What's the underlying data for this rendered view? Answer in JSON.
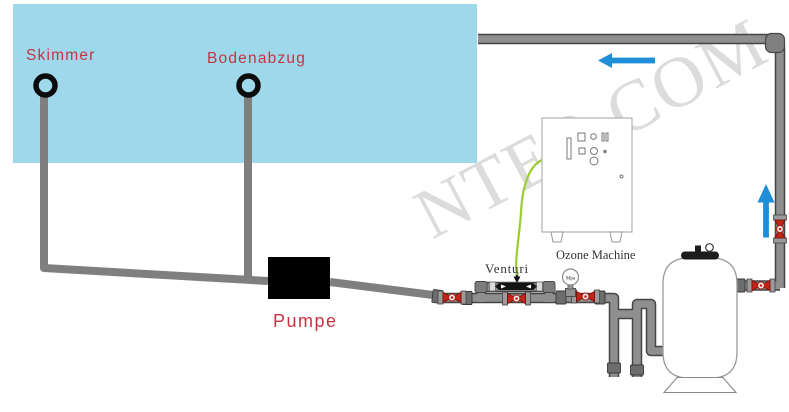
{
  "diagram_type": "pool-ozone-filtration-schematic",
  "watermark": {
    "text": "NTER.COM"
  },
  "components": {
    "skimmer": {
      "label": "Skimmer"
    },
    "bodenabzug": {
      "label": "Bodenabzug"
    },
    "pump": {
      "label": "Pumpe"
    },
    "venturi": {
      "label": "Venturi"
    },
    "ozone_machine": {
      "label": "Ozone Machine"
    },
    "pressure_gauge": {
      "label": "Mpa"
    }
  },
  "flow_arrows": [
    {
      "id": "return-line-flow",
      "direction": "left"
    },
    {
      "id": "riser-flow",
      "direction": "up"
    }
  ],
  "colors": {
    "pool_water": "#9fd8ea",
    "pipe_flat_gray": "#7f7f7f",
    "pipe_fill_gray": "#8f8f8f",
    "pipe_outline": "#454545",
    "coupling_gray": "#6d6d6d",
    "valve_red": "#c22418",
    "flow_arrow_blue": "#1e8ed8",
    "ozone_tube_green": "#9acd32",
    "label_red": "#c53441",
    "watermark_gray": "#dcdcdc",
    "pump_black": "#000000"
  }
}
